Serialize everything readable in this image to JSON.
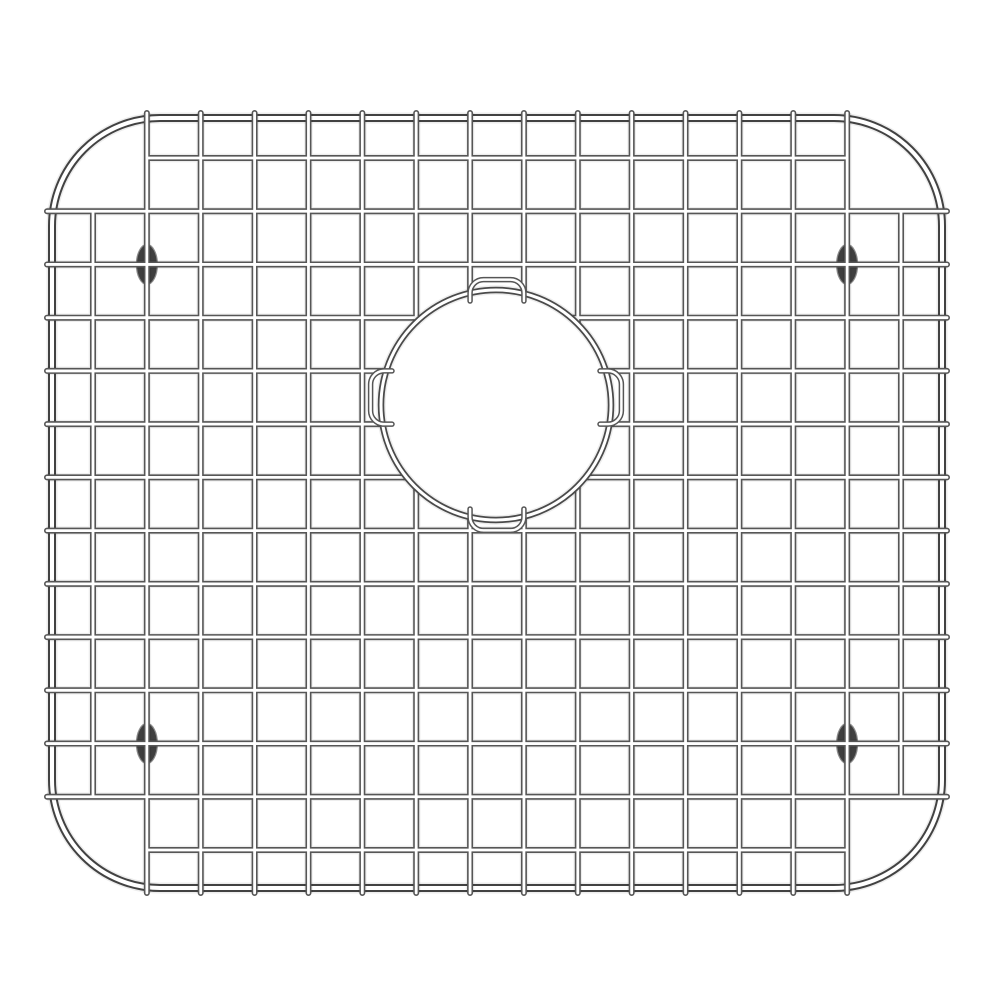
{
  "page": {
    "background_color": "#ffffff"
  },
  "product_image": {
    "subject": "stainless steel kitchen sink bottom grid with circular drain opening and rubber feet",
    "canvas": {
      "width": 1000,
      "height": 1000
    },
    "frame": {
      "left": 52,
      "top": 118,
      "right": 942,
      "bottom": 888,
      "corner_radius": 108,
      "tube_width": 8,
      "core_width": 4
    },
    "grid": {
      "columns": {
        "count": 16,
        "start_x": 93,
        "end_x": 901
      },
      "rows": {
        "count": 14,
        "start_y": 158,
        "end_y": 850
      },
      "tube_width": 6,
      "core_width": 2.8,
      "overhang": 5,
      "note_short_edges": "first and last row span only between 2nd and 15th columns; first and last column span only between 2nd and 13th rows"
    },
    "drain_opening": {
      "cx": 496,
      "cy": 405,
      "radius": 115,
      "tube_width": 6.5,
      "core_width": 3,
      "u_bend_radius": 13.4,
      "u_bend_tube_width": 5.5,
      "u_bend_core_width": 2.5
    },
    "feet": {
      "rx": 10.5,
      "ry": 20,
      "fill": "#3f3f3f",
      "stroke": "#8a8a8a",
      "positions": [
        {
          "cx": 146.9,
          "cy": 264.5
        },
        {
          "cx": 847.1,
          "cy": 264.5
        },
        {
          "cx": 146.9,
          "cy": 743.5
        },
        {
          "cx": 847.1,
          "cy": 743.5
        }
      ]
    },
    "colors": {
      "background": "#ffffff",
      "grid_wire_edge": "#565656",
      "frame_wire_edge": "#424242",
      "ring_wire_edge": "#4a4a4a",
      "wire_core": "#ffffff"
    }
  }
}
